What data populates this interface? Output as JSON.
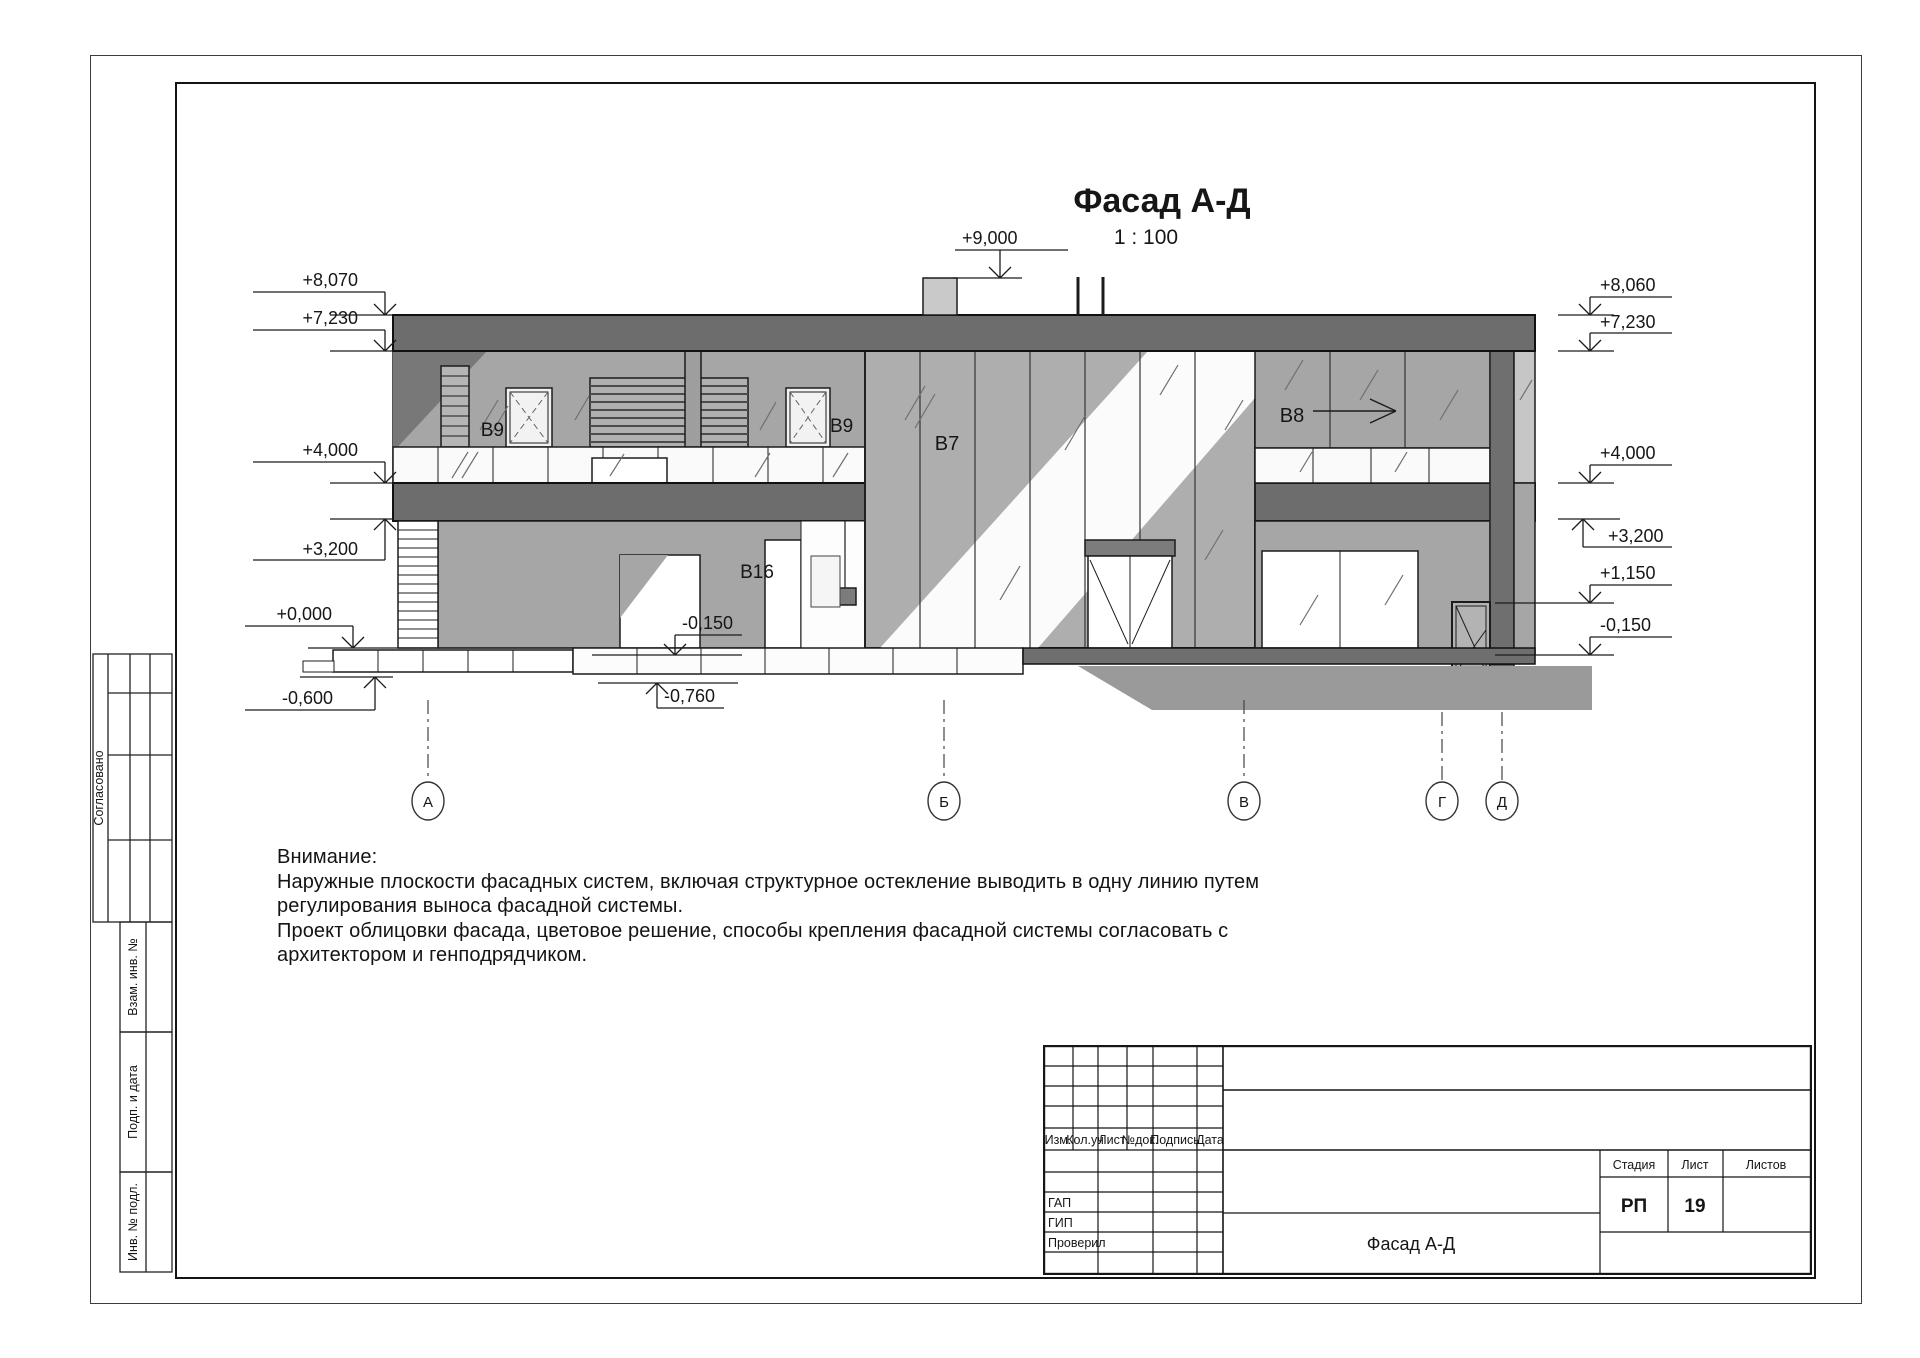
{
  "drawing": {
    "title": "Фасад А-Д",
    "scale": "1 : 100",
    "marks": {
      "top": "+9,000",
      "left": [
        "+8,070",
        "+7,230",
        "+4,000",
        "+3,200",
        "+0,000",
        "-0,600"
      ],
      "right": [
        "+8,060",
        "+7,230",
        "+4,000",
        "+3,200",
        "+1,150",
        "-0,150"
      ],
      "inner": [
        "-0,150",
        "-0,760"
      ]
    },
    "window_labels": [
      "В9",
      "В9",
      "В7",
      "В8",
      "В16"
    ],
    "axes": [
      "А",
      "Б",
      "В",
      "Г",
      "Д"
    ]
  },
  "notes": {
    "heading": "Внимание:",
    "lines": [
      "Наружные плоскости фасадных систем, включая структурное остекление выводить в одну линию путем",
      "регулирования выноса фасадной системы.",
      "Проект облицовки фасада, цветовое решение, способы крепления фасадной системы согласовать с",
      "архитектором и генподрядчиком."
    ]
  },
  "side_stamp": {
    "approved": "Согласовано",
    "replace_inv": "Взам. инв. №",
    "sign_date": "Подп. и дата",
    "inv_no": "Инв. № подл."
  },
  "title_block": {
    "columns": [
      "Изм.",
      "Кол.уч",
      "Лист",
      "№док.",
      "Подпись",
      "Дата"
    ],
    "roles": [
      "ГАП",
      "ГИП",
      "Проверил"
    ],
    "stage_label": "Стадия",
    "sheet_label": "Лист",
    "sheets_label": "Листов",
    "stage": "РП",
    "sheet_number": "19",
    "doc_name": "Фасад А-Д"
  },
  "colors": {
    "band_dark": "#6d6d6d",
    "wall_gray": "#a6a6a6",
    "glass_gray": "#aeaeae",
    "shadow_gray": "#9a9a9a",
    "chimney": "#c9c9c9",
    "line": "#1c1c1c"
  }
}
